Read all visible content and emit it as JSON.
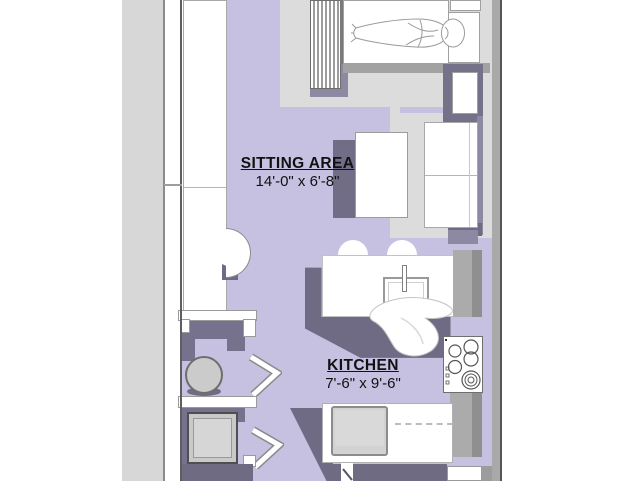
{
  "palette": {
    "floor_lavender": "#c6c1e0",
    "floor_gray": "#dcdcdc",
    "shadow_purple": "#6f6b85",
    "shadow_purple_light": "#8d89a2",
    "counter_gray": "#ababab",
    "counter_gray_dark": "#8f8f8f",
    "outside_gray": "#d7d7d7",
    "wall_dark": "#565656",
    "appliance_gray": "#cbcbcb",
    "text_black": "#111111"
  },
  "rooms": {
    "sitting_area": {
      "name": "SITTING AREA",
      "dimensions": "14'-0\" x 6'-8\""
    },
    "kitchen": {
      "name": "KITCHEN",
      "dimensions": "7'-6\" x 9'-6\""
    }
  },
  "fixtures": [
    "bed",
    "person-figure",
    "headboard-slats",
    "pillow",
    "nightstand",
    "sofa",
    "coffee-table",
    "kitchen-island",
    "bar-stools",
    "island-sink",
    "faucet",
    "towel",
    "cooktop",
    "under-counter-sink",
    "dishwasher-dash-line",
    "closet-round-fixture",
    "washer",
    "bifold-door",
    "refrigerator"
  ]
}
